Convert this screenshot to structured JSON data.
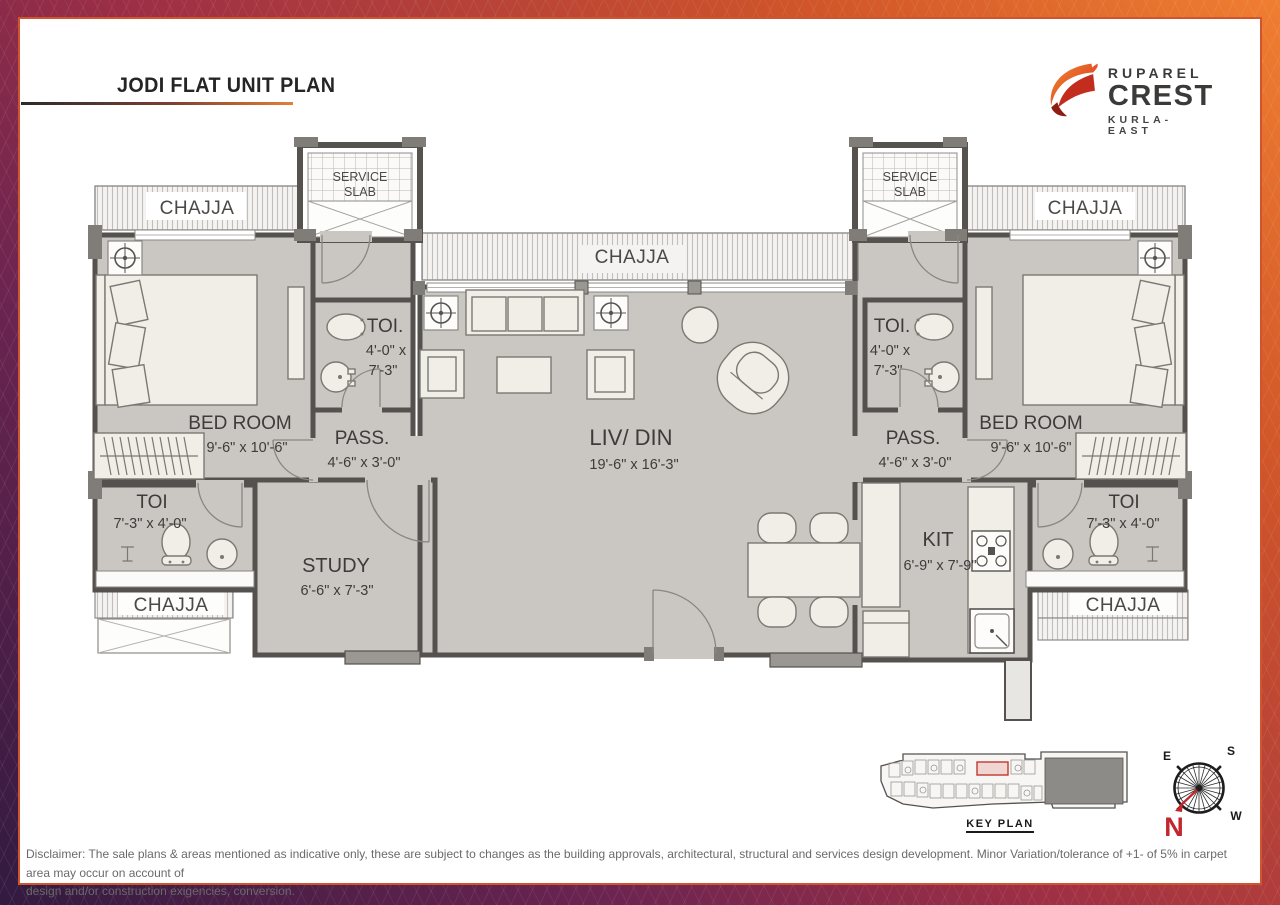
{
  "header": {
    "title": "JODI FLAT UNIT PLAN"
  },
  "logo": {
    "brand": "RUPAREL",
    "name": "CREST",
    "location": "KURLA-EAST"
  },
  "plan": {
    "chajja_top_left": "CHAJJA",
    "chajja_top_center": "CHAJJA",
    "chajja_top_right": "CHAJJA",
    "chajja_bottom_left": "CHAJJA",
    "chajja_bottom_right": "CHAJJA",
    "service_slab_left": {
      "line1": "SERVICE",
      "line2": "SLAB"
    },
    "service_slab_right": {
      "line1": "SERVICE",
      "line2": "SLAB"
    },
    "toilet_upper_left": {
      "name": "TOI.",
      "dims_line1": "4'-0\" x",
      "dims_line2": "7'-3\""
    },
    "toilet_upper_right": {
      "name": "TOI.",
      "dims_line1": "4'-0\" x",
      "dims_line2": "7'-3\""
    },
    "bedroom_left": {
      "name": "BED ROOM",
      "dims": "9'-6\" x 10'-6\""
    },
    "bedroom_right": {
      "name": "BED ROOM",
      "dims": "9'-6\" x 10'-6\""
    },
    "passage_left": {
      "name": "PASS.",
      "dims": "4'-6\" x 3'-0\""
    },
    "passage_right": {
      "name": "PASS.",
      "dims": "4'-6\" x 3'-0\""
    },
    "living_dining": {
      "name": "LIV/ DIN",
      "dims": "19'-6\" x 16'-3\""
    },
    "toilet_lower_left": {
      "name": "TOI",
      "dims": "7'-3\" x 4'-0\""
    },
    "toilet_lower_right": {
      "name": "TOI",
      "dims": "7'-3\" x 4'-0\""
    },
    "study": {
      "name": "STUDY",
      "dims": "6'-6\" x 7'-3\""
    },
    "kitchen": {
      "name": "KIT",
      "dims": "6'-9\" x 7'-9\""
    }
  },
  "key_plan": {
    "label": "KEY PLAN"
  },
  "compass": {
    "n": "N",
    "e": "E",
    "s": "S",
    "w": "W"
  },
  "disclaimer": {
    "line1": "Disclaimer: The sale plans & areas mentioned as indicative only, these are subject to changes as the building approvals, architectural, structural and services design development. Minor Variation/tolerance of +1- of 5% in carpet area may occur on account of",
    "line2": "design and/or construction exigencies, conversion."
  },
  "colors": {
    "accent_orange": "#e2662b",
    "frame_orange": "#f07e30",
    "frame_maroon": "#9e2f45",
    "frame_purple": "#321a40",
    "inner_border": "#d0542e",
    "wall": "#54514e",
    "floor": "#cac6c1",
    "furniture": "#f1eee7",
    "key_highlight_red": "#c0392b",
    "compass_north_red": "#c1272d"
  }
}
